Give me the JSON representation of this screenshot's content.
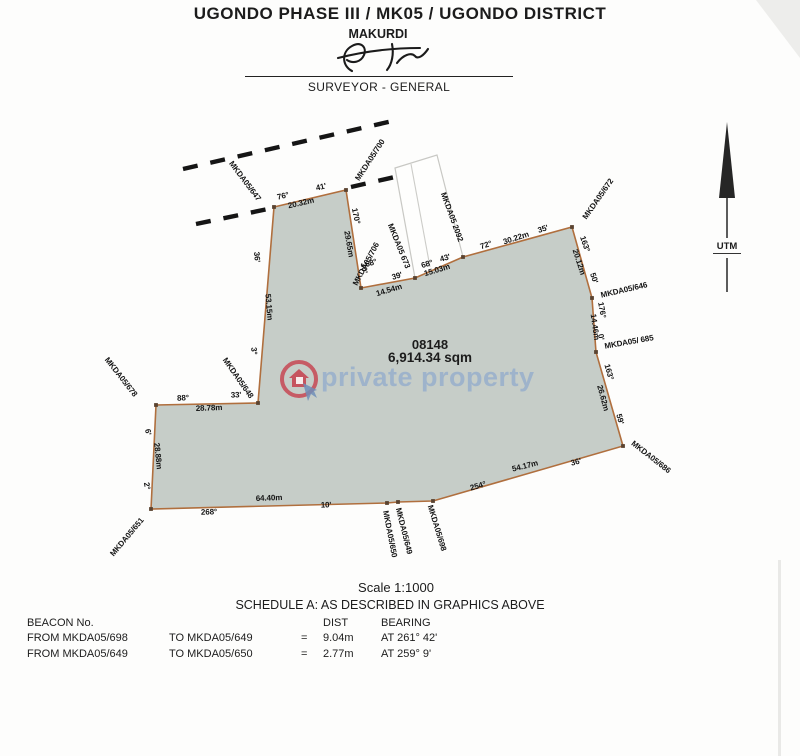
{
  "header": {
    "title": "UGONDO PHASE III / MK05 / UGONDO DISTRICT",
    "subtitle": "MAKURDI",
    "signatory_title": "SURVEYOR - GENERAL"
  },
  "north_arrow": {
    "label": "UTM"
  },
  "watermark": {
    "text": "private property",
    "logo": "house-in-circle",
    "accent_red": "#c districts23c49",
    "accent_blue": "#7d9ecd"
  },
  "parcel": {
    "number": "08148",
    "area": "6,914.34 sqm",
    "scale": "Scale 1:1000",
    "fill_color": "#c6cdc8",
    "boundary_color": "#b06f3e"
  },
  "plot": {
    "vertices": [
      {
        "name": "MKDA05/647",
        "x": 274,
        "y": 207
      },
      {
        "name": "MKDA05/700",
        "x": 346,
        "y": 190
      },
      {
        "name": "MKDA05/706",
        "x": 361,
        "y": 288
      },
      {
        "name": "corner-14.54",
        "x": 415,
        "y": 278
      },
      {
        "name": "corner-15.03",
        "x": 463,
        "y": 257
      },
      {
        "name": "MKDA05/672",
        "x": 572,
        "y": 227
      },
      {
        "name": "MKDA05/646",
        "x": 592,
        "y": 298
      },
      {
        "name": "MKDA05/685",
        "x": 596,
        "y": 352
      },
      {
        "name": "MKDA05/686",
        "x": 623,
        "y": 446
      },
      {
        "name": "MKDA05/698",
        "x": 433,
        "y": 501
      },
      {
        "name": "MKDA05/649",
        "x": 398,
        "y": 502
      },
      {
        "name": "MKDA05/650",
        "x": 387,
        "y": 503
      },
      {
        "name": "MKDA05/651",
        "x": 151,
        "y": 509
      },
      {
        "name": "MKDA05/678",
        "x": 156,
        "y": 405
      },
      {
        "name": "MKDA05/648",
        "x": 258,
        "y": 403
      }
    ],
    "adjacent_parcel": {
      "points": [
        [
          395,
          168
        ],
        [
          437,
          155
        ],
        [
          463,
          257
        ],
        [
          415,
          278
        ]
      ],
      "divider": [
        411,
        164,
        430,
        267
      ]
    },
    "dashed_lines": [
      [
        183,
        169,
        397,
        120
      ],
      [
        196,
        224,
        268,
        209
      ],
      [
        351,
        187,
        421,
        171
      ]
    ],
    "labels": [
      {
        "t": "MKDA05/647",
        "x": 245,
        "y": 181,
        "r": 53
      },
      {
        "t": "MKDA05/700",
        "x": 370,
        "y": 160,
        "r": -57
      },
      {
        "t": "MKDA05/706",
        "x": 366,
        "y": 264,
        "r": -62
      },
      {
        "t": "MKDA05 673",
        "x": 399,
        "y": 246,
        "r": 68
      },
      {
        "t": "MKDA05 2092",
        "x": 452,
        "y": 217,
        "r": 70
      },
      {
        "t": "MKDA05/672",
        "x": 598,
        "y": 199,
        "r": -55
      },
      {
        "t": "MKDA05/646",
        "x": 624,
        "y": 290,
        "r": -13
      },
      {
        "t": "MKDA05/ 685",
        "x": 629,
        "y": 342,
        "r": -10
      },
      {
        "t": "MKDA05/686",
        "x": 651,
        "y": 457,
        "r": 38
      },
      {
        "t": "MKDA05/698",
        "x": 437,
        "y": 528,
        "r": 73
      },
      {
        "t": "MKDA05/649",
        "x": 404,
        "y": 531,
        "r": 76
      },
      {
        "t": "MKDA05/650",
        "x": 390,
        "y": 534,
        "r": 79
      },
      {
        "t": "MKDA05/651",
        "x": 127,
        "y": 537,
        "r": -50
      },
      {
        "t": "MKDA05/678",
        "x": 121,
        "y": 377,
        "r": 52
      },
      {
        "t": "MKDA05/648",
        "x": 238,
        "y": 378,
        "r": 55
      },
      {
        "t": "76°",
        "x": 283,
        "y": 196,
        "r": -13
      },
      {
        "t": "41'",
        "x": 321,
        "y": 187,
        "r": -13
      },
      {
        "t": "20.32m",
        "x": 301,
        "y": 203,
        "r": -13
      },
      {
        "t": "170°",
        "x": 356,
        "y": 216,
        "r": 78
      },
      {
        "t": "29.65m",
        "x": 349,
        "y": 244,
        "r": 80
      },
      {
        "t": "30'",
        "x": 364,
        "y": 268,
        "r": 80
      },
      {
        "t": "68°",
        "x": 371,
        "y": 263,
        "r": -17
      },
      {
        "t": "39'",
        "x": 397,
        "y": 276,
        "r": -17
      },
      {
        "t": "14.54m",
        "x": 389,
        "y": 290,
        "r": -17
      },
      {
        "t": "68°",
        "x": 427,
        "y": 264,
        "r": -17
      },
      {
        "t": "43'",
        "x": 445,
        "y": 258,
        "r": -17
      },
      {
        "t": "15.03m",
        "x": 437,
        "y": 270,
        "r": -17
      },
      {
        "t": "72°",
        "x": 486,
        "y": 245,
        "r": -18
      },
      {
        "t": "30.22m",
        "x": 516,
        "y": 238,
        "r": -18
      },
      {
        "t": "35'",
        "x": 543,
        "y": 229,
        "r": -18
      },
      {
        "t": "163°",
        "x": 585,
        "y": 244,
        "r": 71
      },
      {
        "t": "20.12m",
        "x": 579,
        "y": 262,
        "r": 72
      },
      {
        "t": "50'",
        "x": 594,
        "y": 278,
        "r": 72
      },
      {
        "t": "176°",
        "x": 602,
        "y": 310,
        "r": 80
      },
      {
        "t": "14.46m",
        "x": 595,
        "y": 327,
        "r": 82
      },
      {
        "t": "0'",
        "x": 601,
        "y": 337,
        "r": 80
      },
      {
        "t": "163°",
        "x": 609,
        "y": 372,
        "r": 74
      },
      {
        "t": "26.62m",
        "x": 603,
        "y": 398,
        "r": 75
      },
      {
        "t": "59'",
        "x": 620,
        "y": 419,
        "r": 75
      },
      {
        "t": "54.17m",
        "x": 525,
        "y": 466,
        "r": -14
      },
      {
        "t": "36'",
        "x": 576,
        "y": 462,
        "r": -14
      },
      {
        "t": "254°",
        "x": 478,
        "y": 486,
        "r": -16
      },
      {
        "t": "64.40m",
        "x": 269,
        "y": 498,
        "r": -2
      },
      {
        "t": "10'",
        "x": 326,
        "y": 505,
        "r": -2
      },
      {
        "t": "268°",
        "x": 209,
        "y": 512,
        "r": -2
      },
      {
        "t": "2°",
        "x": 147,
        "y": 486,
        "r": 80
      },
      {
        "t": "28.88m",
        "x": 158,
        "y": 456,
        "r": 84
      },
      {
        "t": "6'",
        "x": 148,
        "y": 432,
        "r": 80
      },
      {
        "t": "88°",
        "x": 183,
        "y": 398,
        "r": -2
      },
      {
        "t": "33'",
        "x": 236,
        "y": 395,
        "r": -2
      },
      {
        "t": "28.78m",
        "x": 209,
        "y": 408,
        "r": -2
      },
      {
        "t": "3°",
        "x": 254,
        "y": 351,
        "r": 84
      },
      {
        "t": "53.15m",
        "x": 269,
        "y": 307,
        "r": 85
      },
      {
        "t": "36'",
        "x": 257,
        "y": 257,
        "r": 85
      }
    ]
  },
  "schedule": {
    "heading": "SCHEDULE A: AS DESCRIBED IN GRAPHICS ABOVE",
    "col_beacon": "BEACON No.",
    "col_dist": "DIST",
    "col_bearing": "BEARING",
    "rows": [
      {
        "from": "FROM MKDA05/698",
        "to": "TO MKDA05/649",
        "eq": "=",
        "dist": "9.04m",
        "bearing": "AT  261° 42'"
      },
      {
        "from": "FROM MKDA05/649",
        "to": "TO MKDA05/650",
        "eq": "=",
        "dist": "2.77m",
        "bearing": "AT  259° 9'"
      }
    ]
  }
}
